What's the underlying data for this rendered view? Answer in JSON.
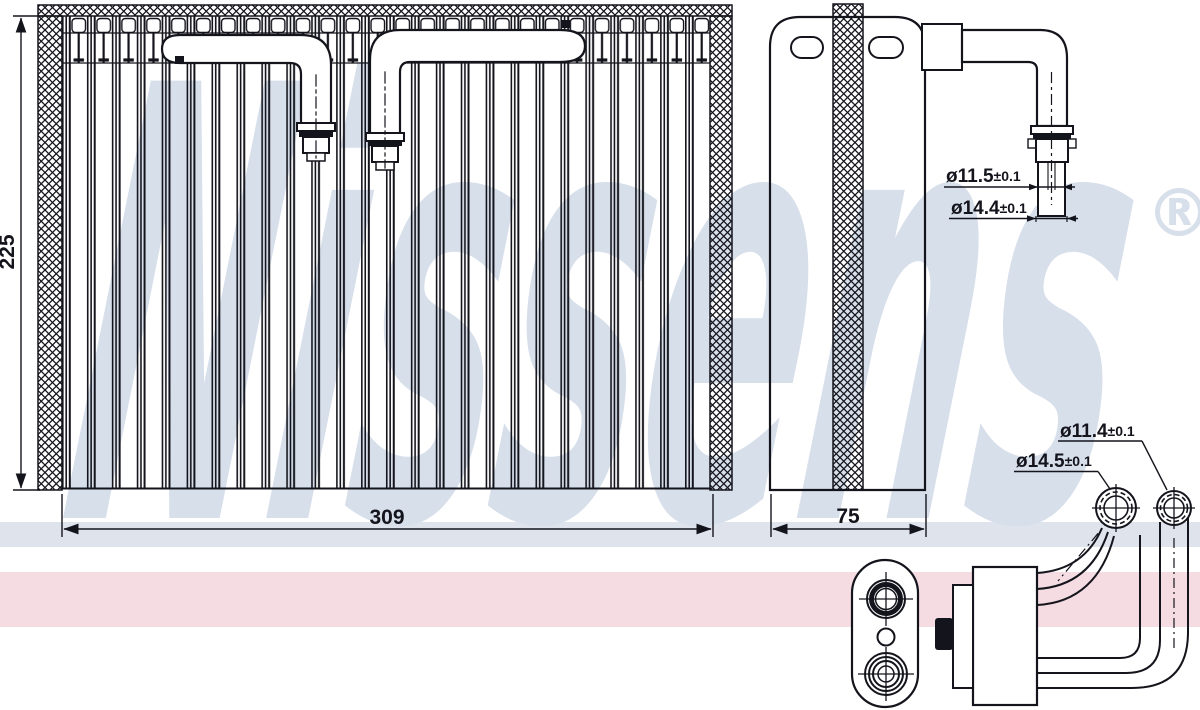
{
  "watermark": {
    "text": "Nissens",
    "registered": "®"
  },
  "colors": {
    "watermark": "#d7dfeb",
    "stripe_blue": "#dfe4ec",
    "stripe_pink": "#f5dce2",
    "line": "#14141c"
  },
  "views": {
    "front": {
      "height_label": "225",
      "width_label": "309"
    },
    "side": {
      "depth_label": "75"
    }
  },
  "fitting_labels": {
    "side_tube": {
      "dia": "ø11.5",
      "tol": "±0.1"
    },
    "side_collar": {
      "dia": "ø14.4",
      "tol": "±0.1"
    },
    "conn_small": {
      "dia": "ø11.4",
      "tol": "±0.1"
    },
    "conn_large": {
      "dia": "ø14.5",
      "tol": "±0.1"
    }
  }
}
